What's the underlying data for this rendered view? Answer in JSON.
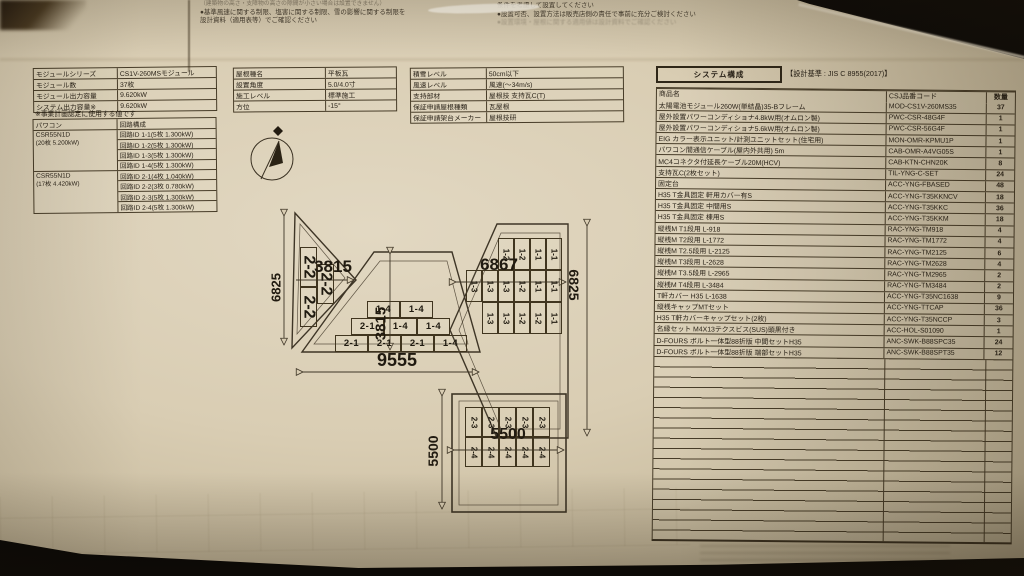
{
  "top_notes": {
    "left_line1": "（建築物の高さ・支障物の高さの隙間が小さい場合は設置できません）",
    "left_line2": "●基準風速に関する制限、塩害に関する制限、雪の影響に関する制限を",
    "left_line3": "設計資料（適用表等）でご確認ください",
    "right_line1": "条件を考慮して設置してください",
    "right_line2": "●設置可否、設置方法は販売店側の責任で事前に充分ご検討ください",
    "right_line3": "●設置環境・屋根に関する適用値は設計資料でご確認ください"
  },
  "module_table": {
    "rows": [
      {
        "label": "モジュールシリーズ",
        "value": "CS1V-260MSモジュール"
      },
      {
        "label": "モジュール数",
        "value": "37枚"
      },
      {
        "label": "モジュール出力容量",
        "value": "9.620kW"
      },
      {
        "label": "システム出力容量※",
        "value": "9.620kW"
      }
    ],
    "note": "※事業計画認定に使用する値です"
  },
  "inverter_table": {
    "col1_header": "パワコン",
    "col2_header": "回路構成",
    "groups": [
      {
        "name": "CSR55N1D",
        "sub": "(20枚 5.200kW)",
        "circuits": [
          "回路ID 1-1(5枚 1.300kW)",
          "回路ID 1-2(5枚 1.300kW)",
          "回路ID 1-3(5枚 1.300kW)",
          "回路ID 1-4(5枚 1.300kW)"
        ]
      },
      {
        "name": "CSR55N1D",
        "sub": "(17枚 4.420kW)",
        "circuits": [
          "回路ID 2-1(4枚 1.040kW)",
          "回路ID 2-2(3枚 0.780kW)",
          "回路ID 2-3(5枚 1.300kW)",
          "回路ID 2-4(5枚 1.300kW)"
        ]
      }
    ]
  },
  "roof_table": {
    "rows": [
      {
        "label": "屋根種名",
        "value": "平板瓦"
      },
      {
        "label": "設置角度",
        "value": "5.0/4.0寸"
      },
      {
        "label": "施工レベル",
        "value": "標準施工"
      },
      {
        "label": "方位",
        "value": "-15°"
      }
    ]
  },
  "env_table": {
    "rows": [
      {
        "label": "積雪レベル",
        "value": "50cm以下"
      },
      {
        "label": "風速レベル",
        "value": "風速(～34m/s)"
      },
      {
        "label": "支持部材",
        "value": "屋根技 支持瓦C(T)"
      },
      {
        "label": "保証申請屋根種類",
        "value": "瓦屋根"
      },
      {
        "label": "保証申請架台メーカー",
        "value": "屋根技研"
      }
    ]
  },
  "system_table": {
    "title": "システム構成",
    "standard": "【設計基準 : JIS C 8955(2017)】",
    "columns": [
      "商品名",
      "CSJ品番コード",
      "数量"
    ],
    "rows": [
      [
        "太陽電池モジュール260W(単結晶)35-Bフレーム",
        "MOD-CS1V-260MS35",
        "37"
      ],
      [
        "屋外設置パワーコンディショナ4.8kW用(オムロン製)",
        "PWC-CSR-48G4F",
        "1"
      ],
      [
        "屋外設置パワーコンディショナ5.6kW用(オムロン製)",
        "PWC-CSR-56G4F",
        "1"
      ],
      [
        "EIG カラー表示ユニット/計測ユニットセット(住宅用)",
        "MON-OMR-KPMU1P",
        "1"
      ],
      [
        "パワコン間通信ケーブル(屋内外共用) 5m",
        "CAB-OMR-A4VG05S",
        "1"
      ],
      [
        "MC4コネクタ付延長ケーブル20M(HCV)",
        "CAB-KTN-CHN20K",
        "8"
      ],
      [
        "支持瓦C(2枚セット)",
        "TIL-YNG-C-SET",
        "24"
      ],
      [
        "固定台",
        "ACC-YNG-FBASED",
        "48"
      ],
      [
        "H35 T金具固定 軒用カバー有S",
        "ACC-YNG-T35KKNCV",
        "18"
      ],
      [
        "H35 T金具固定 中間用S",
        "ACC-YNG-T35KKC",
        "36"
      ],
      [
        "H35 T金具固定 棟用S",
        "ACC-YNG-T35KKM",
        "18"
      ],
      [
        "縦桟M T1段用 L-918",
        "RAC-YNG-TM918",
        "4"
      ],
      [
        "縦桟M T2段用 L-1772",
        "RAC-YNG-TM1772",
        "4"
      ],
      [
        "縦桟M T2.5段用 L-2125",
        "RAC-YNG-TM2125",
        "6"
      ],
      [
        "縦桟M T3段用 L-2628",
        "RAC-YNG-TM2628",
        "4"
      ],
      [
        "縦桟M T3.5段用 L-2965",
        "RAC-YNG-TM2965",
        "2"
      ],
      [
        "縦桟M T4段用 L-3484",
        "RAC-YNG-TM3484",
        "2"
      ],
      [
        "T軒カバー H35 L-1638",
        "ACC-YNG-T35NC1638",
        "9"
      ],
      [
        "縦桟キャップMTセット",
        "ACC-YNG-TTCAP",
        "36"
      ],
      [
        "H35 T軒カバーキャップセット(2枚)",
        "ACC-YNG-T35NCCP",
        "3"
      ],
      [
        "名縁セット M4X13テクスビス(SUS)頭黒付き",
        "ACC-HOL-S01090",
        "1"
      ],
      [
        "D-FOURS ボルト一体型88折版 中間セットH35",
        "ANC-SWK-B88SPC35",
        "24"
      ],
      [
        "D-FOURS ボルト一体型88折版 端部セットH35",
        "ANC-SWK-B88SPT35",
        "12"
      ]
    ]
  },
  "diagram": {
    "left_roof": {
      "dim_height": "6825",
      "dim_width": "3815",
      "cells": [
        "2-2",
        "2-2",
        "2-2"
      ]
    },
    "center_roof": {
      "dim_slope": "3815",
      "dim_width": "9555",
      "rows": [
        [
          "1-4",
          "1-4"
        ],
        [
          "2-1",
          "1-4",
          "1-4"
        ],
        [
          "2-1",
          "2-1",
          "2-1",
          "1-4"
        ]
      ]
    },
    "right_roof": {
      "dim_width": "6867",
      "dim_height": "6825",
      "rows": [
        [
          "1-2",
          "1-2",
          "1-1",
          "1-1"
        ],
        [
          "1-3",
          "1-3",
          "1-3",
          "1-2",
          "1-1",
          "1-1"
        ],
        [
          "1-3",
          "1-3",
          "1-2",
          "1-2",
          "1-1"
        ]
      ]
    },
    "south_roof": {
      "dim_width": "5500",
      "dim_height": "5500",
      "rows": [
        [
          "2-3",
          "2-3",
          "2-3",
          "2-3",
          "2-3"
        ],
        [
          "2-4",
          "2-4",
          "2-4",
          "2-4",
          "2-4"
        ]
      ]
    }
  }
}
